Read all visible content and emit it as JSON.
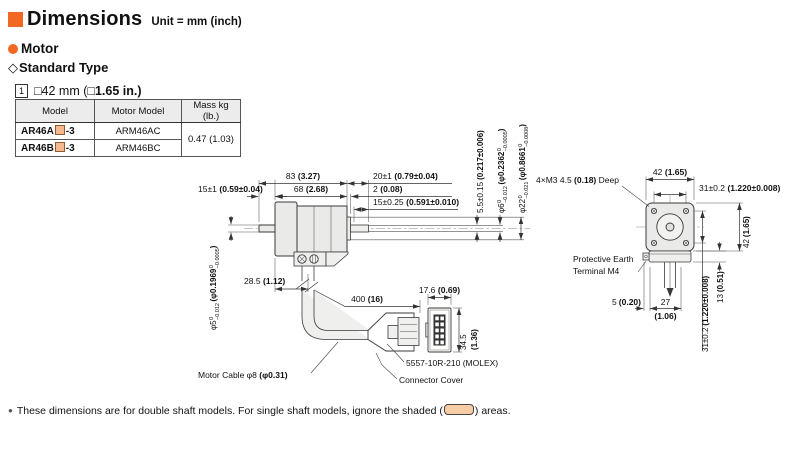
{
  "colors": {
    "accent": "#f26822",
    "shaded_fill": "#f5b98d",
    "swatch_fill": "#f7cda6"
  },
  "header": {
    "title": "Dimensions",
    "unit_note": "Unit = mm (inch)",
    "section_label": "Motor",
    "subsection_marker": "◇",
    "subsection_label": "Standard Type",
    "frame_ref": "1",
    "frame_size_mm": "□42 mm (",
    "frame_size_inch": "□1.65 in.)"
  },
  "table": {
    "headers": [
      "Model",
      "Motor Model",
      "Mass kg (lb.)"
    ],
    "rows": [
      {
        "model_prefix": "AR46A",
        "model_suffix": "-3",
        "motor_model": "ARM46AC"
      },
      {
        "model_prefix": "AR46B",
        "model_suffix": "-3",
        "motor_model": "ARM46BC"
      }
    ],
    "mass": "0.47 (1.03)"
  },
  "side_view": {
    "front_shaft_len": {
      "mm": "15±1",
      "inch": "(0.59±0.04)"
    },
    "total_len": {
      "mm": "83",
      "inch": "(3.27)"
    },
    "body_len": {
      "mm": "68",
      "inch": "(2.68)"
    },
    "rear_shaft_len": {
      "mm": "20±1",
      "inch": "(0.79±0.04)"
    },
    "pilot_len": {
      "mm": "2",
      "inch": "(0.08)"
    },
    "flat_len": {
      "mm": "15±0.25",
      "inch": "(0.591±0.010)"
    },
    "pilot_height": {
      "mm": "5.5±0.15",
      "inch": "(0.217±0.006)"
    },
    "rear_shaft_dia": {
      "mm": "φ6",
      "mm_sup": "0",
      "mm_sub": "−0.012",
      "inch": "(φ0.2362",
      "inch_sup": "0",
      "inch_sub": "−0.0005",
      "close": ")"
    },
    "pilot_dia": {
      "mm": "φ22",
      "mm_sup": "0",
      "mm_sub": "−0.021",
      "inch": "(φ0.8661",
      "inch_sup": "0",
      "inch_sub": "−0.0008",
      "close": ")"
    },
    "front_shaft_dia": {
      "mm": "φ5",
      "mm_sup": "0",
      "mm_sub": "−0.012",
      "inch": "(φ0.1969",
      "inch_sup": "0",
      "inch_sub": "−0.0005",
      "close": ")"
    },
    "cable_offset": {
      "mm": "28.5",
      "inch": "(1.12)"
    },
    "cable_len": {
      "mm": "400",
      "inch": "(16)"
    },
    "cable_label": {
      "pre": "Motor Cable φ8 ",
      "inch": "(φ0.31)"
    },
    "connector_w": {
      "mm": "17.6",
      "inch": "(0.69)"
    },
    "connector_h_mm": "34.5",
    "connector_h_inch": "(1.36)",
    "connector_model": "5557-10R-210 (MOLEX)",
    "connector_cover_label": "Connector Cover"
  },
  "front_view": {
    "face_width": {
      "mm": "42",
      "inch": "(1.65)"
    },
    "face_height": {
      "mm": "42",
      "inch": "(1.65)"
    },
    "hole_pitch_top": {
      "mm": "31±0.2",
      "inch": "(1.220±0.008)"
    },
    "hole_pitch_side": {
      "mm": "31±0.2",
      "inch": "(1.220±0.008)"
    },
    "tap_label": {
      "pre": "4×M3 4.5 ",
      "inch": "(0.18)",
      "post": " Deep"
    },
    "earth_label_line1": "Protective Earth",
    "earth_label_line2": "Terminal M4",
    "terminal_offset": {
      "mm": "5",
      "inch": "(0.20)"
    },
    "cable_pitch_mm": "27",
    "cable_pitch_inch": "(1.06)",
    "housing_height": {
      "mm": "13",
      "inch": "(0.51)"
    }
  },
  "footnote": {
    "pre": "These dimensions are for double shaft models. For single shaft models, ignore the shaded (",
    "post": ") areas."
  }
}
